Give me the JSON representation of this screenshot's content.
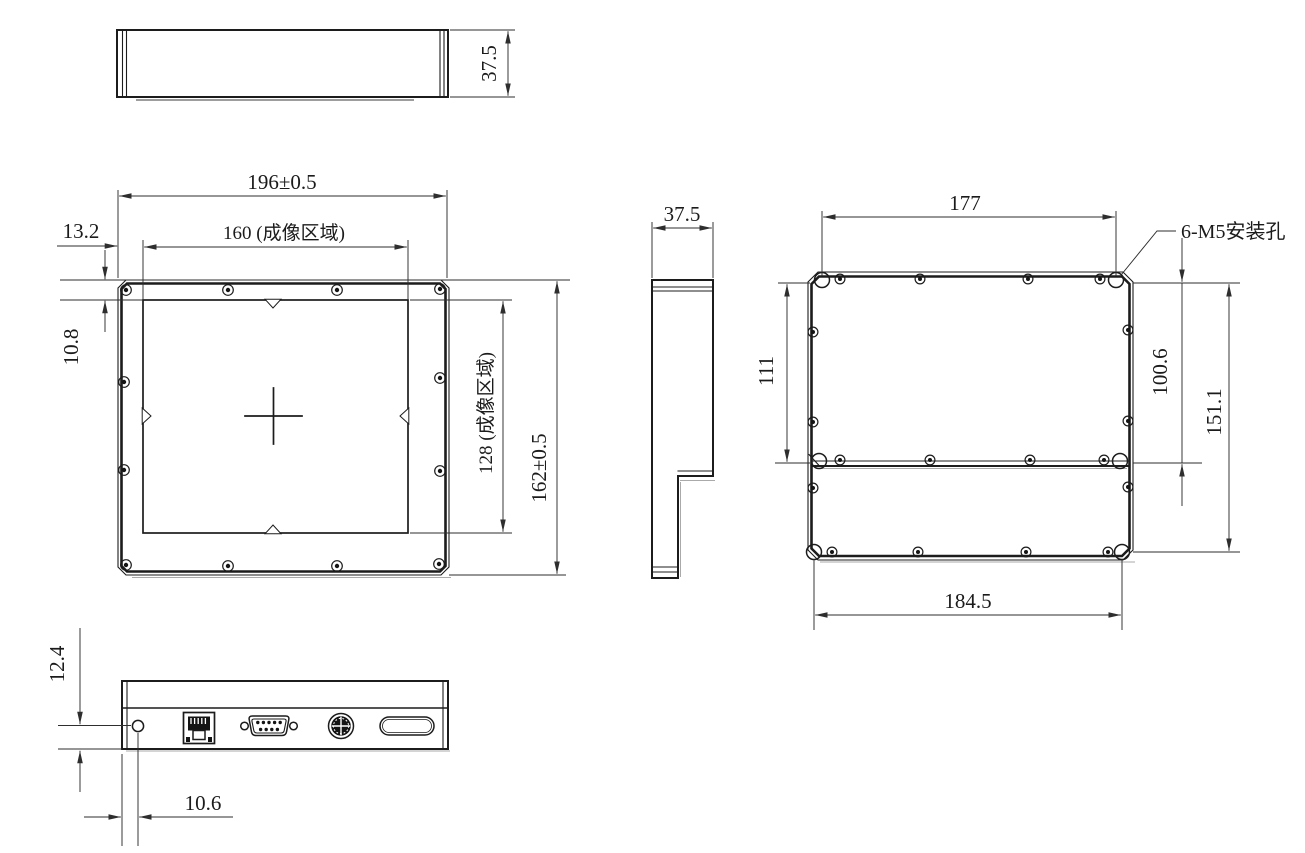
{
  "drawing_title": "panel-detector-dimension-drawing",
  "colors": {
    "background": "#ffffff",
    "object_line": "#1c1c1c",
    "dimension_line": "#2e2e2e"
  },
  "views": {
    "top_view": {
      "height_dim": "37.5"
    },
    "front_view": {
      "width_dim": "196±0.5",
      "imaging_width_dim": "160 (成像区域)",
      "left_offset_dim": "13.2",
      "top_offset_dim": "10.8",
      "imaging_height_dim": "128 (成像区域)",
      "height_dim": "162±0.5"
    },
    "side_view": {
      "thickness_dim": "37.5"
    },
    "rear_view": {
      "top_hole_span_dim": "177",
      "mounting_hole_label": "6-M5安装孔",
      "upper_section_height_dim": "111",
      "upper_hole_span_dim": "100.6",
      "hole_span_height_dim": "151.1",
      "bottom_hole_span_dim": "184.5"
    },
    "bottom_view": {
      "hole_vertical_offset_dim": "12.4",
      "hole_horizontal_offset_dim": "10.6"
    }
  }
}
